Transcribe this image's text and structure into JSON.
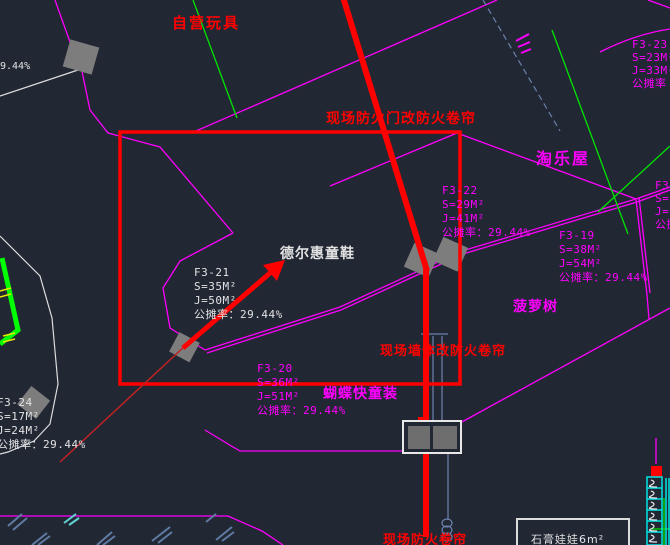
{
  "colors": {
    "background": "#222734",
    "magenta": "#ff00ff",
    "red": "#ff0000",
    "green": "#00e400",
    "white": "#e3e3e3",
    "steel_blue": "#6b82ad",
    "cyan": "#00e5e5",
    "column_gray": "#7d7d7d"
  },
  "labels": {
    "pct_topleft": "9.44%",
    "zone_toys": "自营玩具",
    "note_fire_door": "现场防火门改防火卷帘",
    "zone_taolewu": "淘乐屋",
    "brand_deerhui": "德尔惠童鞋",
    "note_wall": "现场墙体改防火卷帘",
    "zone_pineapple": "菠萝树",
    "brand_butterfly": "蝴蝶快童装",
    "note_shutter": "现场防火卷帘",
    "legend_plaster": "石膏娃娃6m²"
  },
  "units": [
    {
      "lines": [
        "F3-23",
        "S=23M²",
        "J=33M²",
        "公摊率"
      ]
    },
    {
      "lines": [
        "F3-22",
        "S=29M²",
        "J=41M²",
        "公摊率：29.44%"
      ]
    },
    {
      "lines": [
        "F3-19",
        "S=38M²",
        "J=54M²",
        "公摊率：29.44%"
      ]
    },
    {
      "lines": [
        "F3-1",
        "S=1",
        "J=16",
        "公摊率"
      ]
    },
    {
      "lines": [
        "F3-21",
        "S=35M²",
        "J=50M²",
        "公摊率：29.44%"
      ]
    },
    {
      "lines": [
        "F3-20",
        "S=36M²",
        "J=51M²",
        "公摊率：29.44%"
      ]
    },
    {
      "lines": [
        "F3-24",
        "S=17M²",
        "J=24M²",
        "公摊率：29.44%"
      ]
    }
  ]
}
